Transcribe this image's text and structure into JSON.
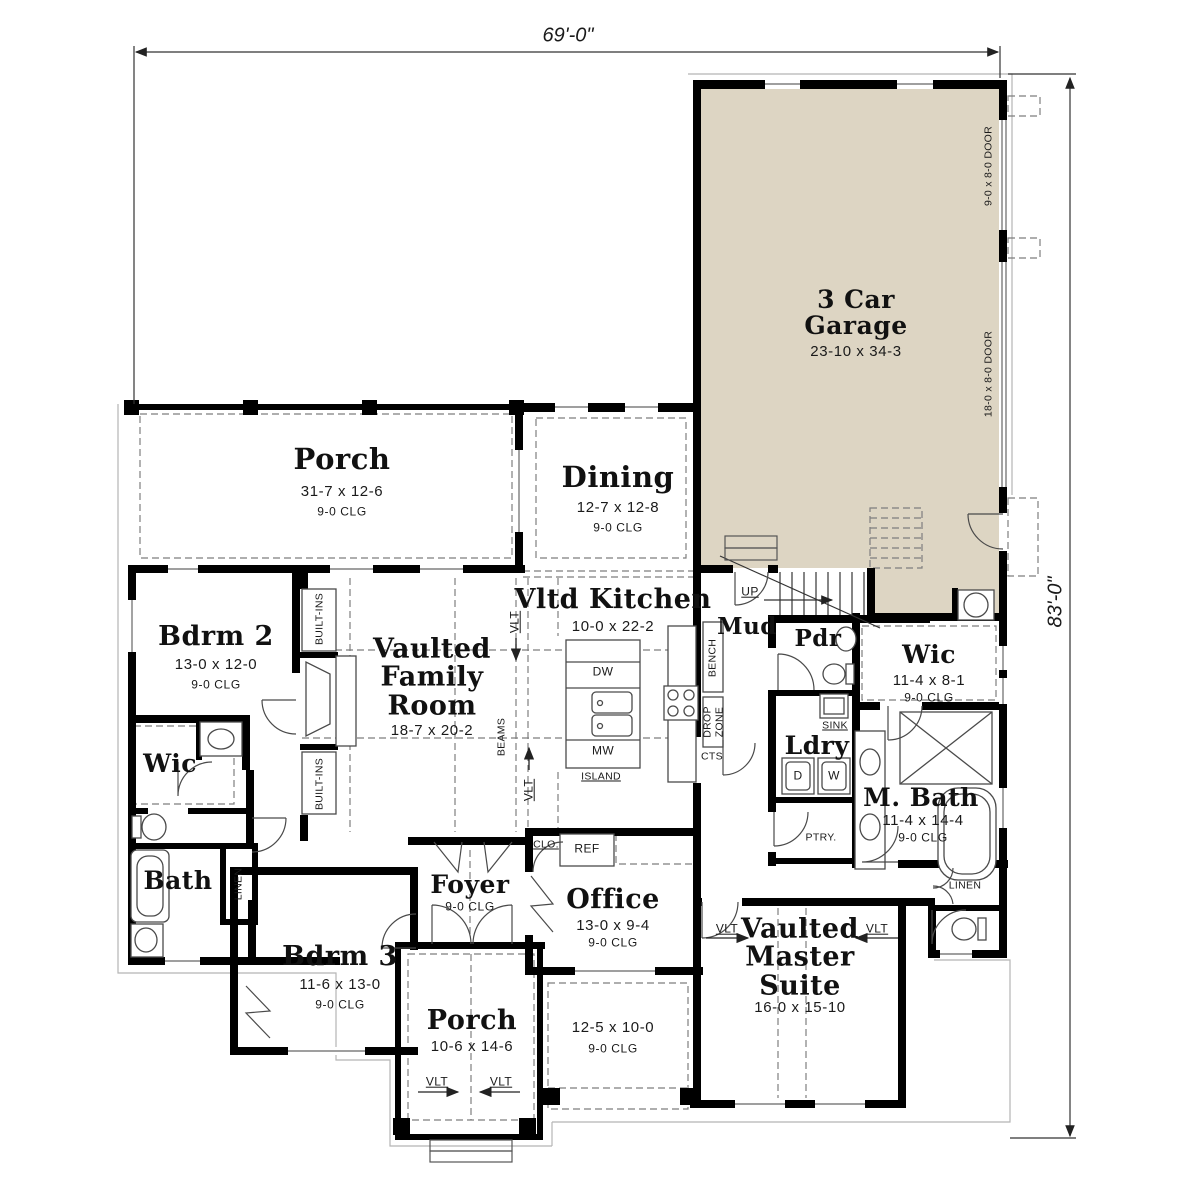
{
  "dims": {
    "width": "69'-0\"",
    "height": "83'-0\""
  },
  "garage": {
    "name": "3 Car Garage",
    "size": "23-10 x 34-3",
    "door_small": "9-0 x 8-0 DOOR",
    "door_large": "18-0 x 8-0 DOOR"
  },
  "rooms": {
    "porch_front": {
      "name": "Porch",
      "size": "31-7 x 12-6",
      "clg": "9-0 CLG"
    },
    "dining": {
      "name": "Dining",
      "size": "12-7 x 12-8",
      "clg": "9-0 CLG"
    },
    "kitchen": {
      "name": "Vltd Kitchen",
      "size": "10-0 x 22-2"
    },
    "family": {
      "name": "Vaulted Family Room",
      "size": "18-7 x 20-2"
    },
    "bdrm2": {
      "name": "Bdrm 2",
      "size": "13-0 x 12-0",
      "clg": "9-0 CLG"
    },
    "wic_left": {
      "name": "Wic"
    },
    "bath": {
      "name": "Bath"
    },
    "bdrm3": {
      "name": "Bdrm 3",
      "size": "11-6 x 13-0",
      "clg": "9-0 CLG"
    },
    "foyer": {
      "name": "Foyer",
      "clg": "9-0 CLG"
    },
    "office": {
      "name": "Office",
      "size": "13-0 x 9-4",
      "clg": "9-0 CLG"
    },
    "porch_rear": {
      "name": "Porch",
      "size": "10-6 x 14-6"
    },
    "patio": {
      "size": "12-5 x 10-0",
      "clg": "9-0 CLG"
    },
    "master": {
      "name": "Vaulted Master Suite",
      "size": "16-0 x 15-10"
    },
    "mud": {
      "name": "Mud"
    },
    "pdr": {
      "name": "Pdr"
    },
    "ldry": {
      "name": "Ldry"
    },
    "wic_right": {
      "name": "Wic",
      "size": "11-4 x 8-1",
      "clg": "9-0 CLG"
    },
    "mbath": {
      "name": "M. Bath",
      "size": "11-4 x 14-4",
      "clg": "9-0 CLG"
    }
  },
  "labels": {
    "up": "UP",
    "vlt": "VLT",
    "beams": "BEAMS",
    "built_ins": "BUILT-INS",
    "bench": "BENCH",
    "drop": "DROP",
    "zone": "ZONE",
    "cts": "CTS",
    "island": "ISLAND",
    "dw": "DW",
    "mw": "MW",
    "ref": "REF",
    "clo": "CLO.",
    "sink": "SINK",
    "dryer": "D",
    "washer": "W",
    "ptry": "PTRY.",
    "linen": "LINEN"
  },
  "colors": {
    "garage_fill": "#ddd5c3",
    "wall": "#000000"
  }
}
